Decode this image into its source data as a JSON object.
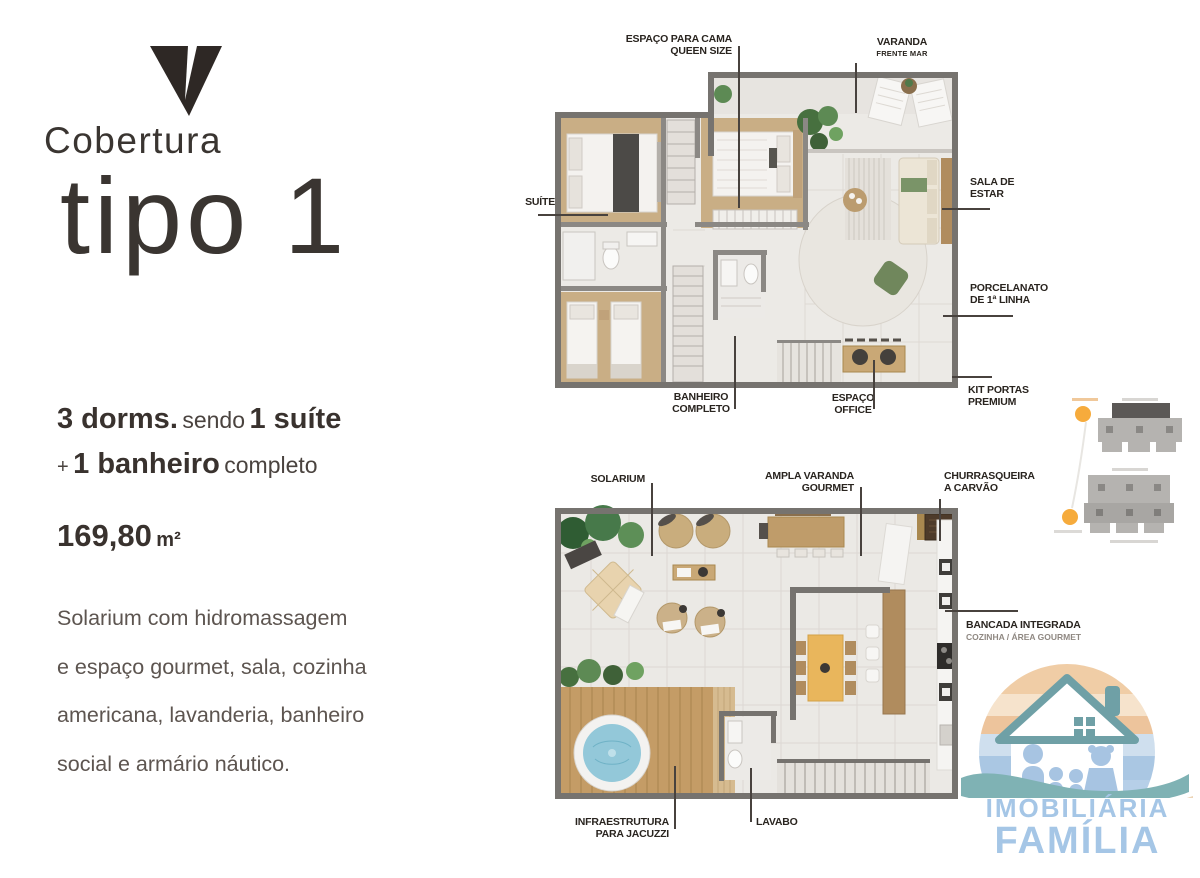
{
  "brand": {
    "title": "Cobertura",
    "subtitle": "tipo 1"
  },
  "left_panel": {
    "spec1": {
      "bold1": "3 dorms.",
      "regular": "sendo",
      "bold2": "1 suíte"
    },
    "spec2": {
      "prefix": "+",
      "bold": "1 banheiro",
      "regular": "completo"
    },
    "area": {
      "value": "169,80",
      "unit": "m²"
    },
    "description_lines": [
      "Solarium com hidromassagem",
      "e espaço gourmet, sala, cozinha",
      "americana, lavanderia, banheiro",
      "social e armário náutico."
    ]
  },
  "upper_plan": {
    "labels": {
      "espaco_cama": {
        "line1": "ESPAÇO PARA CAMA",
        "line2": "QUEEN SIZE"
      },
      "varanda": {
        "line1": "VARANDA",
        "line2": "FRENTE MAR"
      },
      "suite": {
        "line1": "SUÍTE"
      },
      "sala_estar": {
        "line1": "SALA DE",
        "line2": "ESTAR"
      },
      "porcelanato": {
        "line1": "PORCELANATO",
        "line2": "DE 1ª LINHA"
      },
      "kit_portas": {
        "line1": "KIT PORTAS",
        "line2": "PREMIUM"
      },
      "banheiro": {
        "line1": "BANHEIRO",
        "line2": "COMPLETO"
      },
      "office": {
        "line1": "ESPAÇO",
        "line2": "OFFICE"
      }
    }
  },
  "lower_plan": {
    "labels": {
      "solarium": {
        "line1": "SOLARIUM"
      },
      "ampla_varanda": {
        "line1": "AMPLA VARANDA",
        "line2": "GOURMET"
      },
      "churrasqueira": {
        "line1": "CHURRASQUEIRA",
        "line2": "A CARVÃO"
      },
      "bancada": {
        "line1": "BANCADA INTEGRADA",
        "line2": "COZINHA / ÁREA GOURMET"
      },
      "infraestrutura": {
        "line1": "INFRAESTRUTURA",
        "line2": "PARA JACUZZI"
      },
      "lavabo": {
        "line1": "LAVABO"
      }
    }
  },
  "logo": {
    "line1": "IMOBILIÁRIA",
    "line2": "FAMÍLIA"
  },
  "colors": {
    "title_text": "#3a3531",
    "label_text": "#29241f",
    "body_text": "#5d5550",
    "logo_blue": "#a5c6e6",
    "logo_teal": "#6fa0a6",
    "sun_orange": "#f6ab3c",
    "wall_gray": "#7b7773",
    "wood": "#c49c66",
    "jacuzzi_blue": "#93c8d9",
    "table_yellow": "#e9b65c",
    "plant_green": "#47703f"
  }
}
